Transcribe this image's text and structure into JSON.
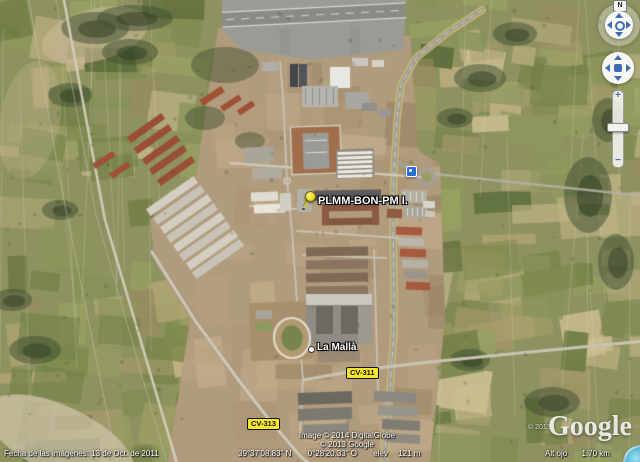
{
  "map": {
    "placemark_label": "PLMM-BON-PM I.",
    "town_label": "La Mallà",
    "shield_cv311": "CV-311",
    "shield_cv313": "CV-313"
  },
  "overlay": {
    "imagery_date": "Fecha de las imágenes: 13 de Oct. de 2011",
    "copyright_line1": "Image © 2014 DigitalGlobe",
    "copyright_line2": "© 2013 Google",
    "watermark_year": "© 2013",
    "watermark_logo": "Google",
    "latitude": "39°37'08.83\" N",
    "longitude": "0°28'20.33\" O",
    "elev_label": "elev",
    "elev_value": "121 m",
    "eye_alt_label": "Alt ojo",
    "eye_alt_value": "1.70 km"
  },
  "nav": {
    "north_label": "N",
    "zoom_in_label": "+",
    "zoom_out_label": "−"
  },
  "colors": {
    "road_shield_bg": "#f7e733",
    "placemark_yellow": "#e8d826",
    "poi_blue": "#2a6fd4",
    "nav_arrow_blue": "#3f6db5"
  }
}
